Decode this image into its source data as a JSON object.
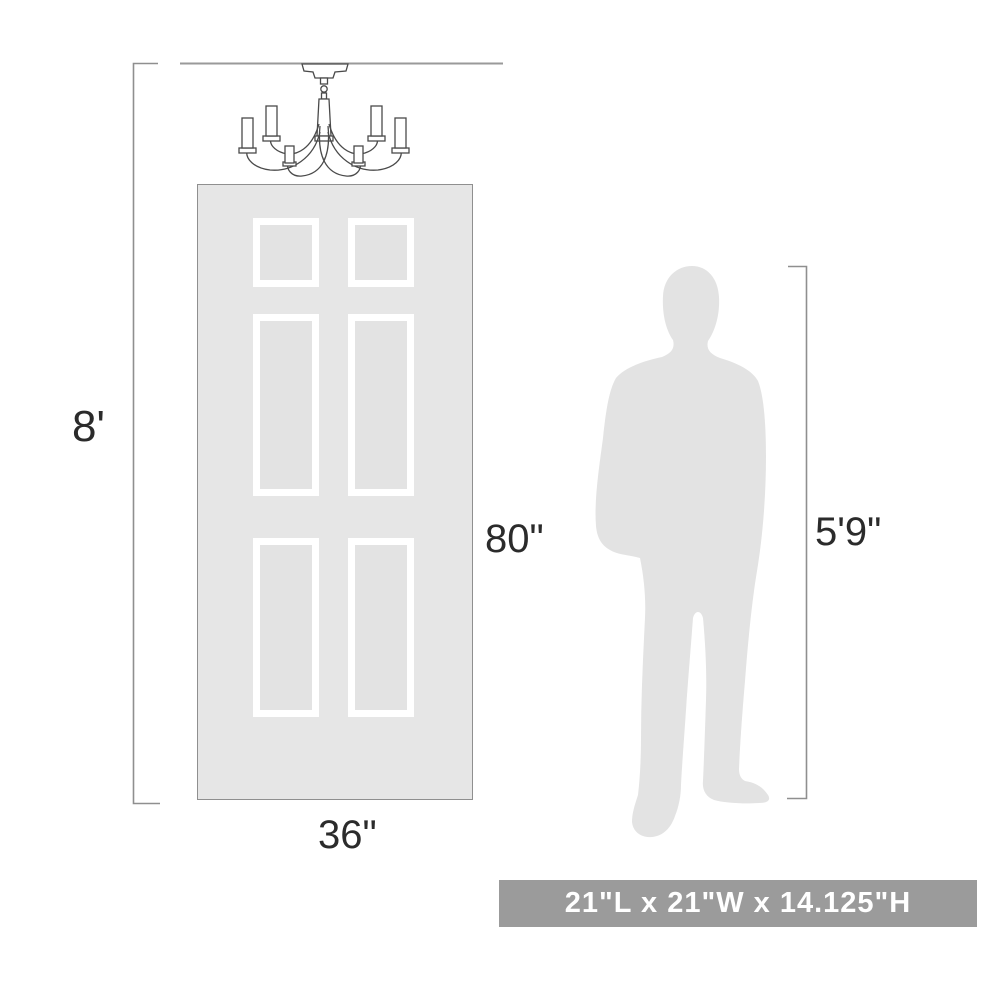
{
  "diagram": {
    "room": {
      "height_label": "8'"
    },
    "door": {
      "height_label": "80\"",
      "width_label": "36\""
    },
    "person": {
      "height_label": "5'9\""
    },
    "fixture": {
      "name": "chandelier"
    },
    "badge": {
      "text": "21\"L x 21\"W x 14.125\"H"
    }
  },
  "colors": {
    "background": "#ffffff",
    "door_fill": "#e6e6e6",
    "door_border": "#8f8f8f",
    "panel_frame": "#ffffff",
    "silhouette_fill": "#e3e3e3",
    "dimension_line": "#8f8f8f",
    "fixture_line": "#4a4a4a",
    "label_text": "#2b2b2b",
    "badge_background": "#9b9b9b",
    "badge_text": "#ffffff"
  }
}
